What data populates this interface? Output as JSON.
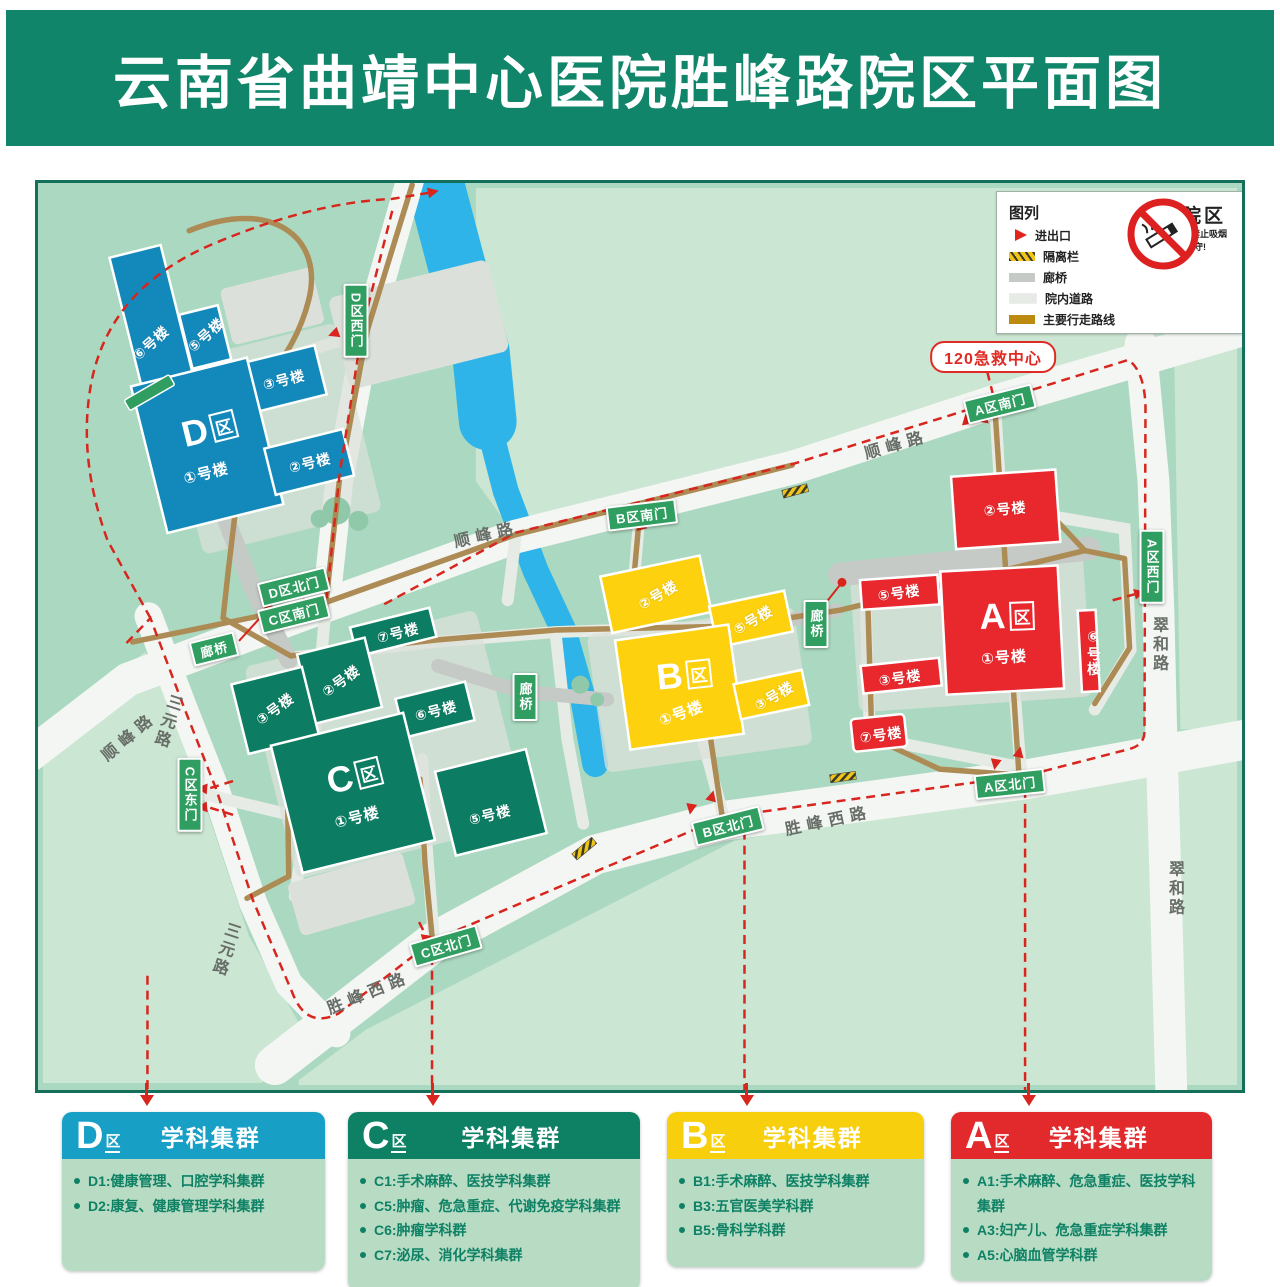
{
  "title": "云南省曲靖中心医院胜峰路院区平面图",
  "legend": {
    "title": "图列",
    "items": [
      {
        "label": "进出口",
        "swatch": "arrow"
      },
      {
        "label": "隔离栏",
        "swatch": "hatch"
      },
      {
        "label": "廊桥",
        "swatch": "corridor"
      },
      {
        "label": "院内道路",
        "swatch": "road"
      },
      {
        "label": "主要行走路线",
        "swatch": "route"
      }
    ]
  },
  "no_smoking": {
    "title": "无烟院区",
    "line1": "院内所有区域禁止吸烟",
    "line2": "请自觉遵守!"
  },
  "map": {
    "emergency": "120急救中心",
    "bridge_label": "廊桥",
    "roads": {
      "shunfeng": "顺峰路",
      "sanyuan": "三元路",
      "shengfengxi": "胜峰西路",
      "cuihe": "翠和路"
    },
    "gates": {
      "d_west": "D区西门",
      "d_north": "D区北门",
      "c_south": "C区南门",
      "c_east": "C区东门",
      "c_north": "C区北门",
      "b_south": "B区南门",
      "b_north": "B区北门",
      "a_south": "A区南门",
      "a_west": "A区西门",
      "a_north": "A区北门"
    },
    "zones": {
      "d": {
        "letter": "D",
        "suffix": "区",
        "b1": "①号楼",
        "b2": "②号楼",
        "b3": "③号楼",
        "b5": "⑤号楼",
        "b6": "⑥号楼"
      },
      "c": {
        "letter": "C",
        "suffix": "区",
        "b1": "①号楼",
        "b2": "②号楼",
        "b3": "③号楼",
        "b5": "⑤号楼",
        "b6": "⑥号楼",
        "b7": "⑦号楼"
      },
      "b": {
        "letter": "B",
        "suffix": "区",
        "b1": "①号楼",
        "b2": "②号楼",
        "b3": "③号楼",
        "b5": "⑤号楼"
      },
      "a": {
        "letter": "A",
        "suffix": "区",
        "b1": "①号楼",
        "b2": "②号楼",
        "b3": "③号楼",
        "b5": "⑤号楼",
        "b6": "⑥号楼",
        "b7": "⑦号楼"
      }
    }
  },
  "clusters": [
    {
      "letter": "D",
      "suffix": "区",
      "title": "学科集群",
      "header_color": "#189fc6",
      "items": [
        "D1:健康管理、口腔学科集群",
        "D2:康复、健康管理学科集群"
      ]
    },
    {
      "letter": "C",
      "suffix": "区",
      "title": "学科集群",
      "header_color": "#0e8165",
      "items": [
        "C1:手术麻醉、医技学科集群",
        "C5:肿瘤、危急重症、代谢免疫学科集群",
        "C6:肿瘤学科群",
        "C7:泌尿、消化学科集群"
      ]
    },
    {
      "letter": "B",
      "suffix": "区",
      "title": "学科集群",
      "header_color": "#f7cf0c",
      "items": [
        "B1:手术麻醉、医技学科集群",
        "B3:五官医美学科群",
        "B5:骨科学科群"
      ]
    },
    {
      "letter": "A",
      "suffix": "区",
      "title": "学科集群",
      "header_color": "#e22a2d",
      "items": [
        "A1:手术麻醉、危急重症、医技学科集群",
        "A3:妇产儿、危急重症学科集群",
        "A5:心脑血管学科群"
      ]
    }
  ],
  "colors": {
    "header_green": "#108569",
    "map_bg": "#abd8c0",
    "parcel_light": "#cbe6d2",
    "river_blue": "#2fb4e9",
    "route_brown": "#ad8b55",
    "route_red": "#d8251d",
    "zone_d": "#1389bb",
    "zone_c": "#0c7c62",
    "zone_b": "#fdd10d",
    "zone_a": "#e8282d",
    "gate_green": "#2f9e60"
  }
}
